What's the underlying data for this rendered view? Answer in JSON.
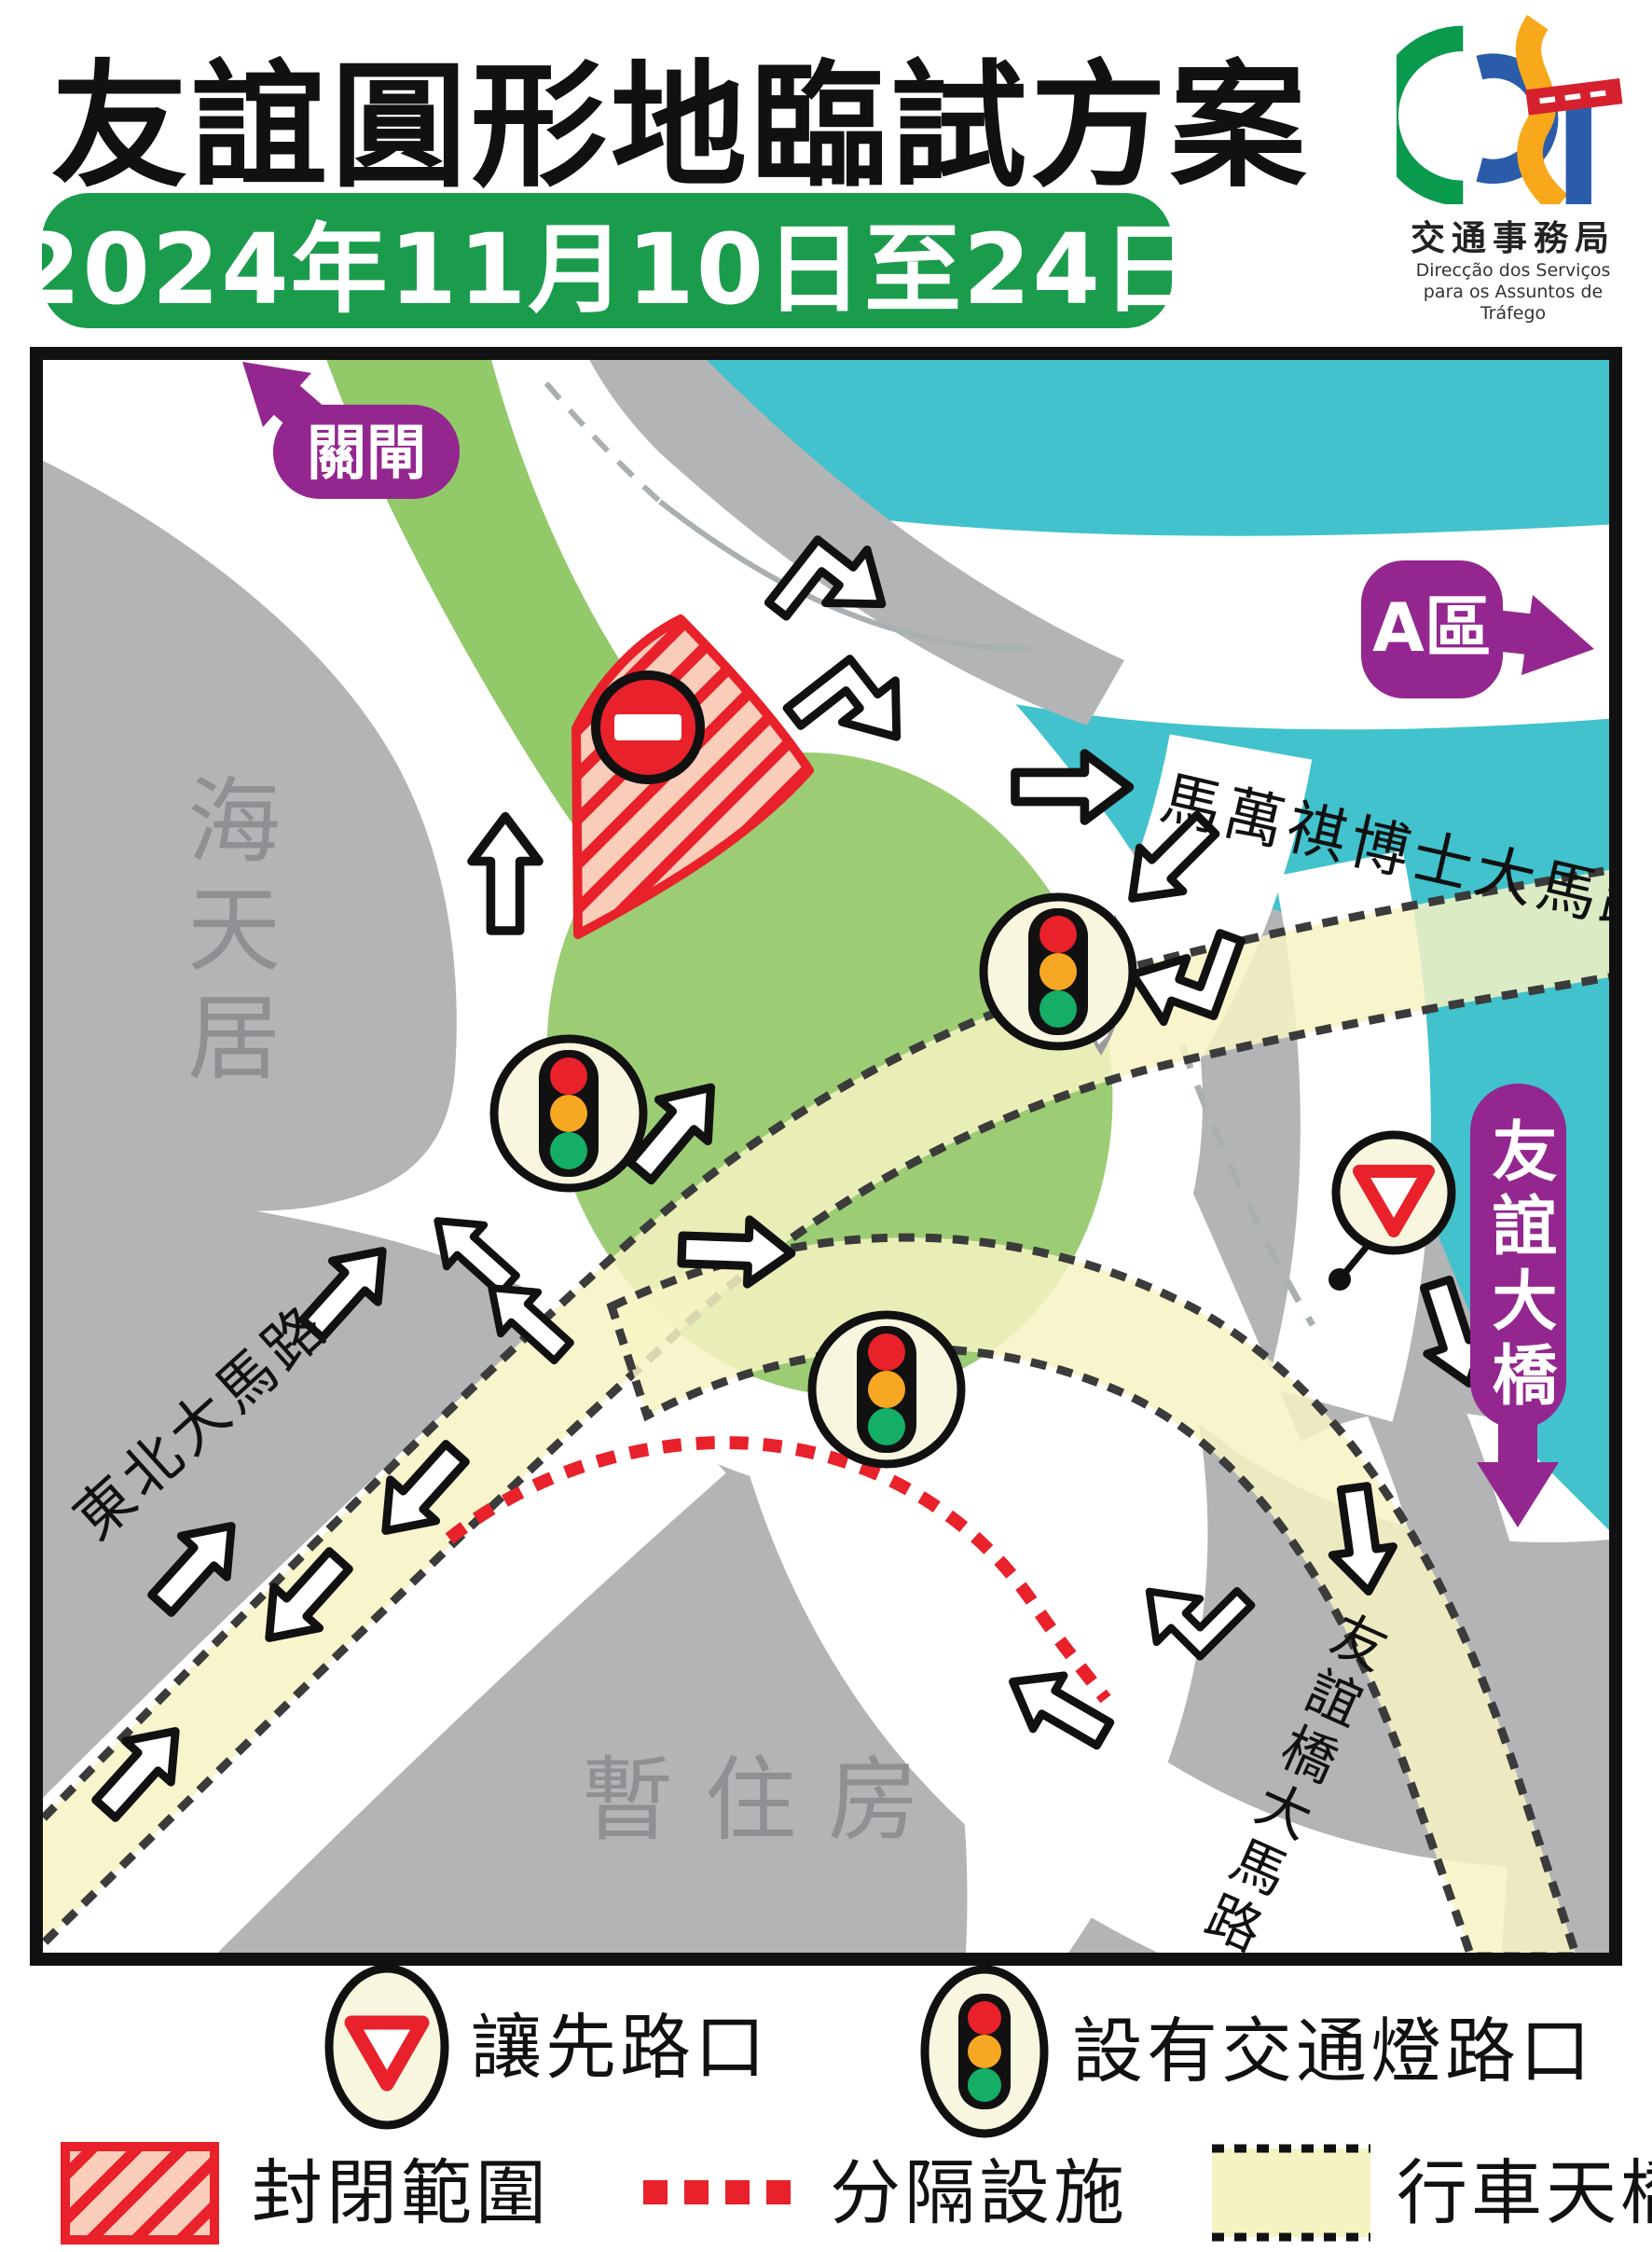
{
  "header": {
    "title": "友誼圓形地臨試方案",
    "date_banner": "2024年11月10日至24日",
    "logo": {
      "cn_name": "交通事務局",
      "pt_line1": "Direcção dos Serviços",
      "pt_line2": "para os Assuntos de Tráfego"
    }
  },
  "map": {
    "direction_labels": {
      "border_gate": "關閘",
      "zone_a": "A區",
      "friendship_bridge": "友誼大橋"
    },
    "road_names": {
      "avenida_dr_ma_man_kei": "馬萬祺博士大馬路",
      "avenida_nordeste": "東北大馬路",
      "avenida_ponte_amizade": "友誼橋大馬路"
    },
    "buildings": {
      "hoi_tin_kui": "海天居",
      "temporary_housing": "暫住房"
    }
  },
  "legend": {
    "yield_label": "讓先路口",
    "signal_label": "設有交通燈路口",
    "closed_area_label": "封閉範圍",
    "separation_label": "分隔設施",
    "flyover_label": "行車天橋"
  },
  "colors": {
    "purple": "#93278F",
    "water": "#41C2CD",
    "banner_green": "#1B9C4D",
    "grass_green": "#97CA6F",
    "flyover_yellow": "#F6F3C3",
    "closure_red": "#E8212A",
    "building_gray": "#B3B4B6"
  }
}
